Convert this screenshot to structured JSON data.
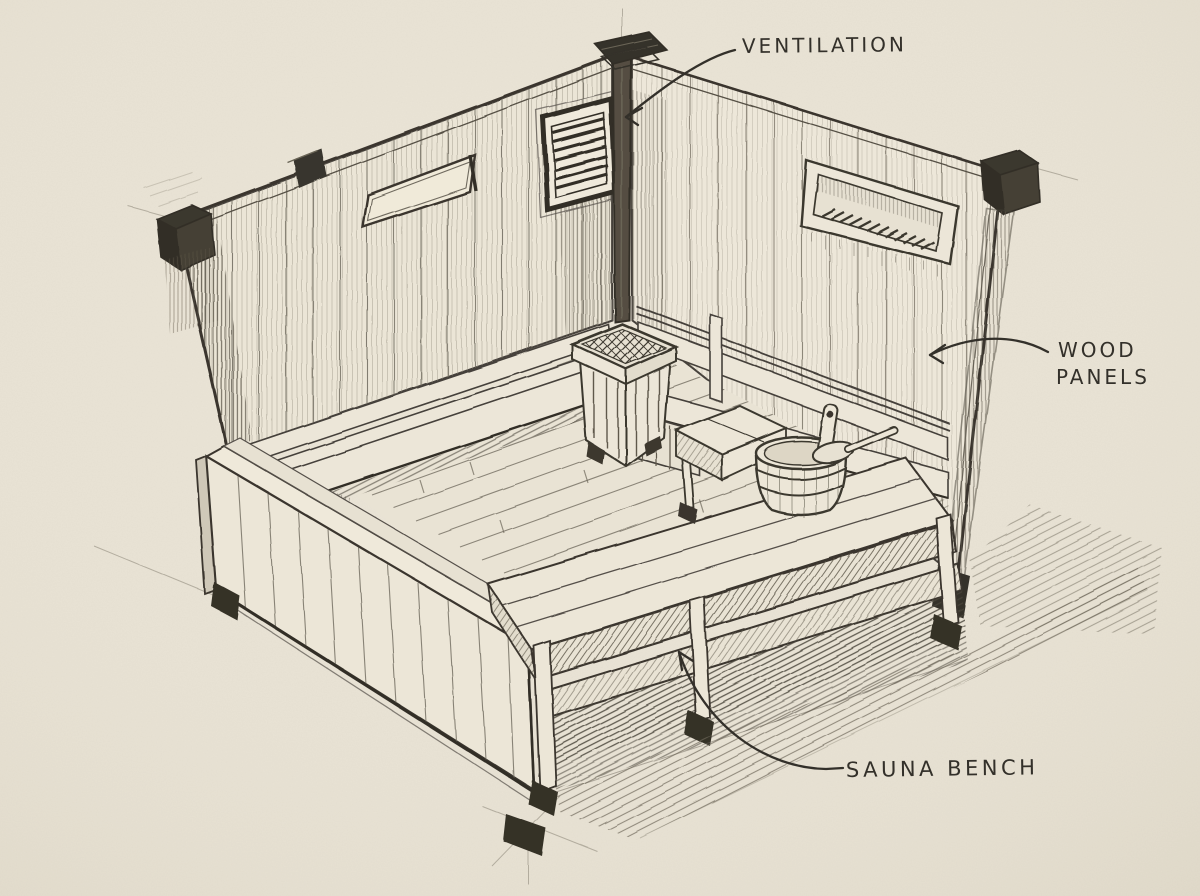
{
  "scene": {
    "paper_color": "#e9e3d5",
    "pencil_color": "#45413a",
    "heavy_pencil_color": "#332f28",
    "marker_color": "#33302a"
  },
  "annotations": {
    "ventilation": {
      "label": "VENTILATION"
    },
    "wood_panels": {
      "line1": "WOOD",
      "line2": "PANELS"
    },
    "sauna_bench": {
      "label": "SAUNA BENCH"
    }
  }
}
